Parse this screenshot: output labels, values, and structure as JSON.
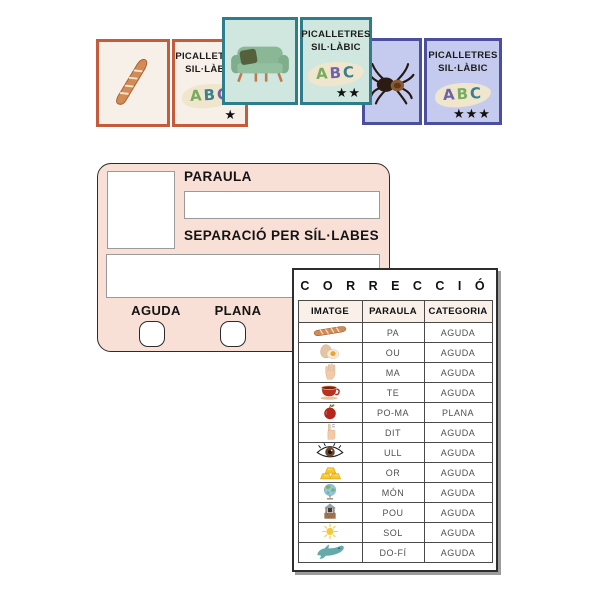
{
  "cards": [
    {
      "image_icon": "baguette-icon",
      "title_line1": "PICALLETRES",
      "title_line2": "SIL·LÀBIC",
      "abc": [
        {
          "letter": "A",
          "color": "#79ab5e"
        },
        {
          "letter": "B",
          "color": "#39808e"
        },
        {
          "letter": "C",
          "color": "#6f63a8"
        }
      ],
      "stars": "★",
      "border_color": "#c65b3c",
      "background_color": "#f7f0e9"
    },
    {
      "image_icon": "sofa-icon",
      "title_line1": "PICALLETRES",
      "title_line2": "SIL·LÀBIC",
      "abc": [
        {
          "letter": "A",
          "color": "#79ab5e"
        },
        {
          "letter": "B",
          "color": "#6f63a8"
        },
        {
          "letter": "C",
          "color": "#39808e"
        }
      ],
      "stars": "★★",
      "border_color": "#2e7d8b",
      "background_color": "#cfe7de"
    },
    {
      "image_icon": "tarantula-icon",
      "title_line1": "PICALLETRES",
      "title_line2": "SIL·LÀBIC",
      "abc": [
        {
          "letter": "A",
          "color": "#6f63a8"
        },
        {
          "letter": "B",
          "color": "#79ab5e"
        },
        {
          "letter": "C",
          "color": "#39808e"
        }
      ],
      "stars": "★★★",
      "border_color": "#4b4f9d",
      "background_color": "#c5cbee"
    }
  ],
  "form": {
    "paraula_label": "PARAULA",
    "paraula_value": "",
    "separacio_label": "SEPARACIÓ PER SÍL·LABES",
    "separacio_value": "",
    "aguda_label": "AGUDA",
    "plana_label": "PLANA",
    "background_color": "#f8e0d6"
  },
  "correction": {
    "title": "C O R R E C C I Ó",
    "headers": [
      "IMATGE",
      "PARAULA",
      "CATEGORIA"
    ],
    "rows": [
      {
        "icon": "baguette-icon",
        "word": "PA",
        "category": "AGUDA"
      },
      {
        "icon": "eggs-icon",
        "word": "OU",
        "category": "AGUDA"
      },
      {
        "icon": "hand-icon",
        "word": "MA",
        "category": "AGUDA"
      },
      {
        "icon": "teacup-icon",
        "word": "TE",
        "category": "AGUDA"
      },
      {
        "icon": "apple-icon",
        "word": "PO-MA",
        "category": "PLANA"
      },
      {
        "icon": "finger-icon",
        "word": "DIT",
        "category": "AGUDA"
      },
      {
        "icon": "eye-icon",
        "word": "ULL",
        "category": "AGUDA"
      },
      {
        "icon": "gold-icon",
        "word": "OR",
        "category": "AGUDA"
      },
      {
        "icon": "globe-icon",
        "word": "MÓN",
        "category": "AGUDA"
      },
      {
        "icon": "well-icon",
        "word": "POU",
        "category": "AGUDA"
      },
      {
        "icon": "sun-icon",
        "word": "SOL",
        "category": "AGUDA"
      },
      {
        "icon": "dolphin-icon",
        "word": "DO-FÍ",
        "category": "AGUDA"
      }
    ]
  }
}
